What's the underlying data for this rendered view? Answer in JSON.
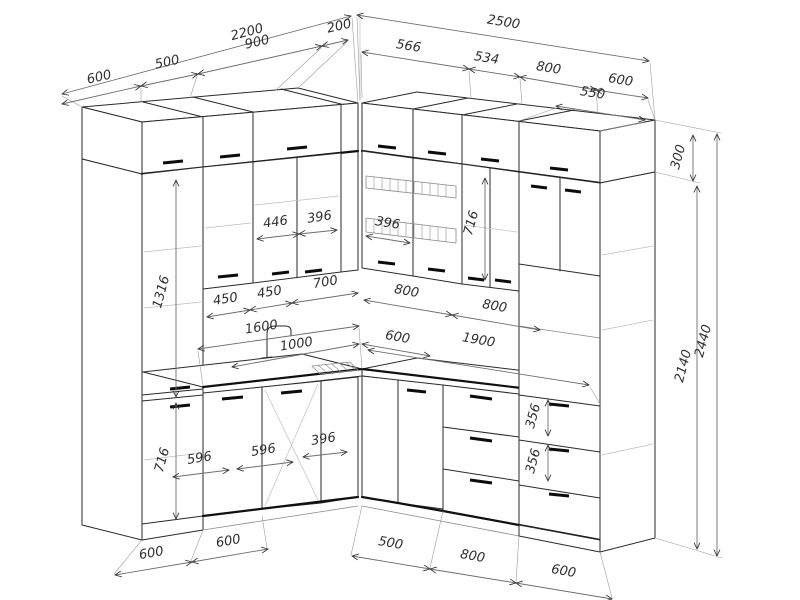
{
  "dims": {
    "left_top": {
      "total": "2200",
      "s1": "600",
      "s2": "500",
      "s3": "900",
      "s4": "200"
    },
    "right_top": {
      "total": "2500",
      "s1": "566",
      "s2": "534",
      "s3": "800",
      "s4": "600",
      "depth": "550"
    },
    "right_side": {
      "box": "300",
      "tall": "2140",
      "total": "2440"
    },
    "left_upper": {
      "a": "446",
      "b": "396"
    },
    "right_upper": {
      "w": "396",
      "h": "716"
    },
    "left_splash": {
      "a": "450",
      "b": "450",
      "c": "700"
    },
    "right_splash": {
      "a": "800",
      "b": "800"
    },
    "counter": {
      "left_total": "1600",
      "left_a": "1000",
      "left_b": "600",
      "right_total": "1900"
    },
    "left_base": {
      "tall_upper": "1316",
      "h": "716",
      "d1": "596",
      "d2": "596",
      "d3": "396"
    },
    "right_base": {
      "dr1": "356",
      "dr2": "356"
    },
    "bottom_left": {
      "a": "600",
      "b": "600"
    },
    "bottom_right": {
      "a": "500",
      "b": "800",
      "c": "600"
    }
  }
}
